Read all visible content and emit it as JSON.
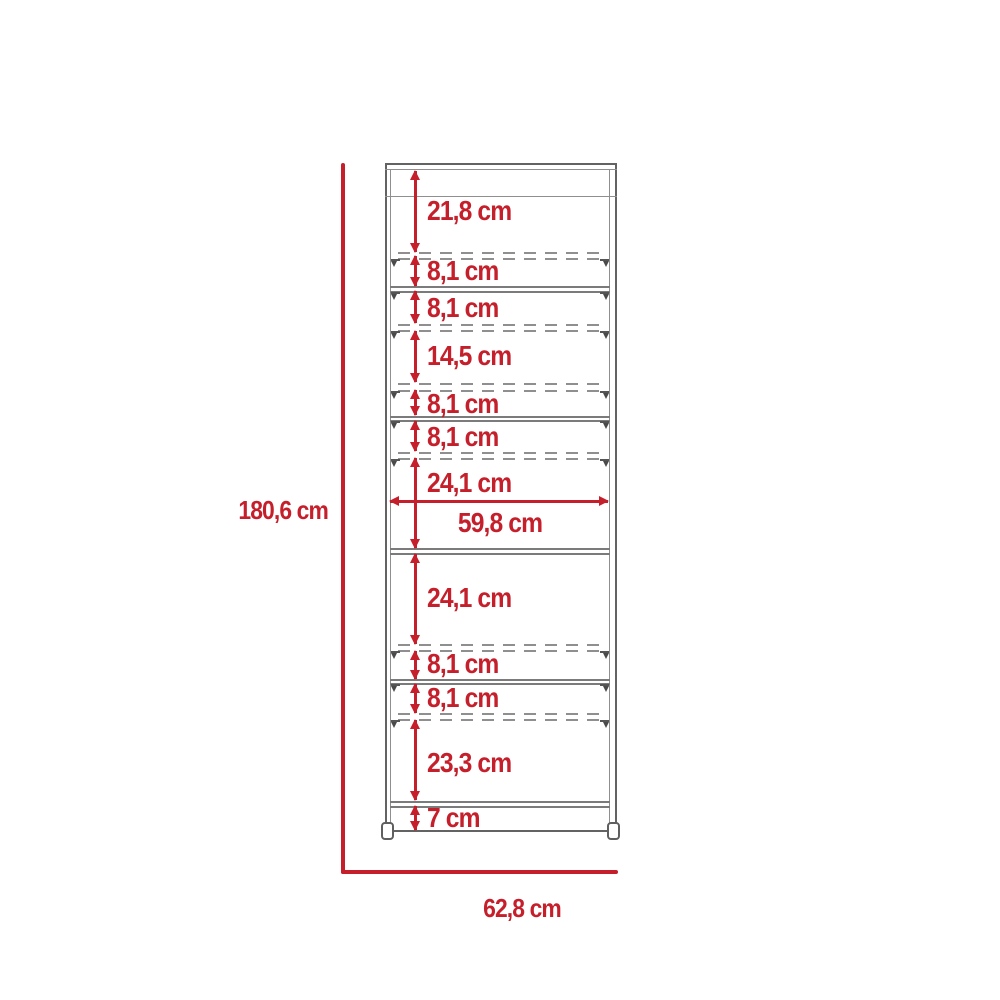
{
  "diagram": {
    "overall": {
      "height_label": "180,6 cm",
      "width_label": "62,8 cm"
    },
    "interior_width_label": "59,8 cm",
    "segments": [
      {
        "label": "21,8 cm"
      },
      {
        "label": "8,1 cm"
      },
      {
        "label": "8,1 cm"
      },
      {
        "label": "14,5 cm"
      },
      {
        "label": "8,1 cm"
      },
      {
        "label": "8,1 cm"
      },
      {
        "label": "24,1 cm"
      },
      {
        "label": "24,1 cm"
      },
      {
        "label": "8,1 cm"
      },
      {
        "label": "8,1 cm"
      },
      {
        "label": "23,3 cm"
      },
      {
        "label": "7 cm"
      }
    ],
    "colors": {
      "dimension_red": "#c41f2b",
      "line_gray": "#8f8f8f",
      "dark_gray": "#636363"
    }
  }
}
